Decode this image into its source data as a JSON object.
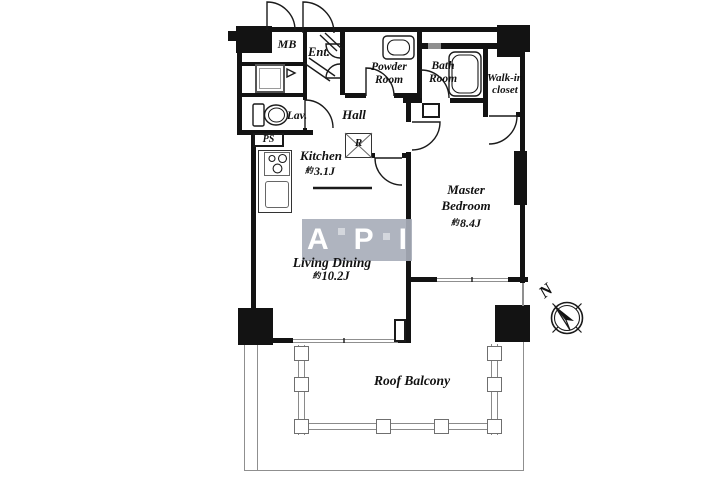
{
  "plan": {
    "rooms": {
      "mb": {
        "label": "MB"
      },
      "entrance": {
        "label": "Ent."
      },
      "powder_room": {
        "label_line1": "Powder",
        "label_line2": "Room"
      },
      "bath_room": {
        "label_line1": "Bath",
        "label_line2": "Room"
      },
      "walkin_closet": {
        "label_line1": "Walk-in",
        "label_line2": "closet"
      },
      "lavatory": {
        "label": "Lav."
      },
      "hall": {
        "label": "Hall"
      },
      "ps": {
        "label": "PS"
      },
      "refrigerator": {
        "label": "R"
      },
      "kitchen": {
        "label": "Kitchen",
        "size_prefix": "約",
        "size": "3.1J"
      },
      "master_bedroom": {
        "label_line1": "Master",
        "label_line2": "Bedroom",
        "size_prefix": "約",
        "size": "8.4J"
      },
      "living_dining": {
        "label": "Living Dining",
        "size_prefix": "約",
        "size": "10.2J"
      },
      "roof_balcony": {
        "label": "Roof Balcony"
      }
    },
    "compass": {
      "north_label": "N"
    },
    "watermark": {
      "letters": [
        "A",
        "P",
        "I"
      ]
    },
    "colors": {
      "wall": "#131313",
      "watermark_bg": "#a8aeba",
      "watermark_text": "#ffffff",
      "line_gray": "#8a8a8a"
    }
  }
}
